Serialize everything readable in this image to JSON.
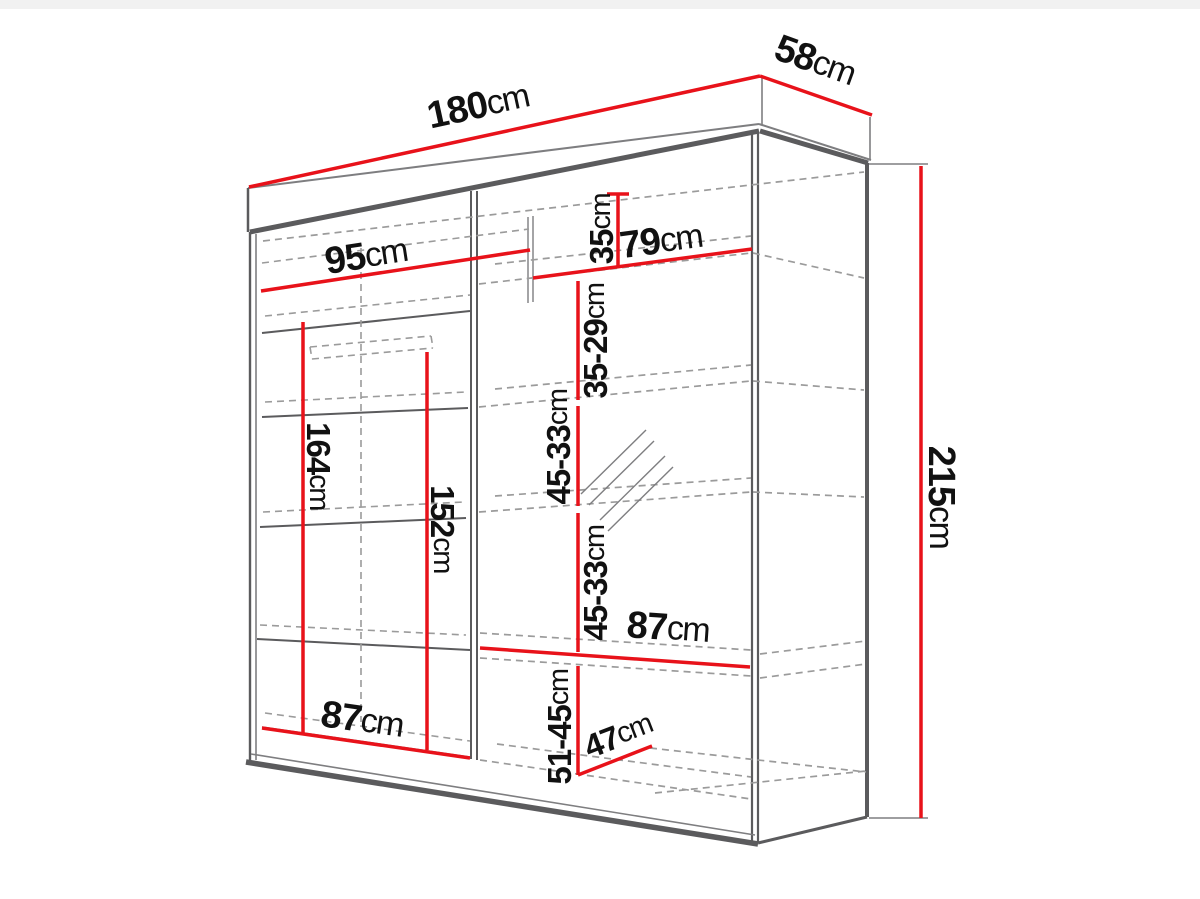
{
  "diagram": {
    "type": "furniture-dimension-diagram",
    "subject": "sliding-door wardrobe with mirror",
    "unit": "cm",
    "colors": {
      "dimension_line": "#e8121a",
      "structure": "#5b5b5d",
      "hidden_line": "#9b9b9b",
      "label_text": "#111111",
      "background": "#ffffff"
    },
    "overall": {
      "width": {
        "value": "180",
        "unit": "cm"
      },
      "depth": {
        "value": "58",
        "unit": "cm"
      },
      "height": {
        "value": "215",
        "unit": "cm"
      }
    },
    "interior": {
      "top_shelf_left_width": {
        "value": "95",
        "unit": "cm"
      },
      "top_shelf_right_width": {
        "value": "79",
        "unit": "cm"
      },
      "top_cubby_height": {
        "value": "35",
        "unit": "cm"
      },
      "upper_right_section_height": {
        "value": "35-29",
        "unit": "cm"
      },
      "mirror_upper_section_height": {
        "value": "45-33",
        "unit": "cm"
      },
      "mirror_lower_section_height": {
        "value": "45-33",
        "unit": "cm"
      },
      "right_shelf_width": {
        "value": "87",
        "unit": "cm"
      },
      "bottom_right_section_height": {
        "value": "51-45",
        "unit": "cm"
      },
      "bottom_shelf_depth": {
        "value": "47",
        "unit": "cm"
      },
      "bottom_left_shelf_width": {
        "value": "87",
        "unit": "cm"
      },
      "left_hanging_height": {
        "value": "164",
        "unit": "cm"
      },
      "left_inner_height": {
        "value": "152",
        "unit": "cm"
      }
    }
  }
}
